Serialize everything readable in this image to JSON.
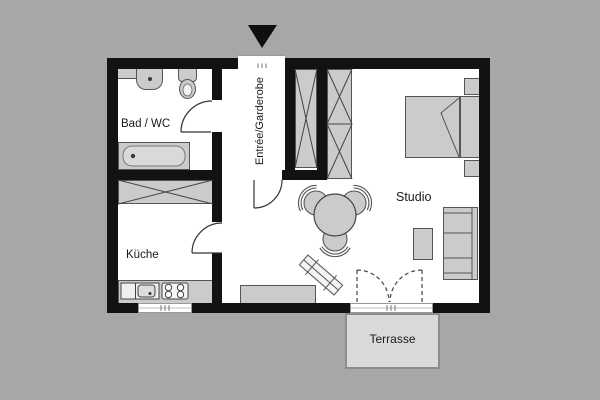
{
  "plan": {
    "type": "apartment-floor-plan",
    "labels": {
      "bathroom": "Bad / WC",
      "entry": "Entrée/Garderobe",
      "kitchen": "Küche",
      "studio": "Studio",
      "terrace": "Terrasse"
    },
    "colors": {
      "background": "#a7a7a7",
      "wall": "#121212",
      "floor": "#ffffff",
      "furniture": "#cbcbcb",
      "furniture_stroke": "#555555",
      "terrace_fill": "#dadada",
      "text": "#1a1a1a"
    },
    "fixtures": [
      "entrance-arrow",
      "wash-basin",
      "toilet",
      "bathtub",
      "kitchen-cabinet",
      "kitchenette-sink",
      "stove",
      "window",
      "wardrobe",
      "dining-table",
      "chair",
      "radiator",
      "sideboard",
      "bed",
      "nightstand",
      "sofa",
      "coffee-table",
      "french-door",
      "door"
    ]
  }
}
